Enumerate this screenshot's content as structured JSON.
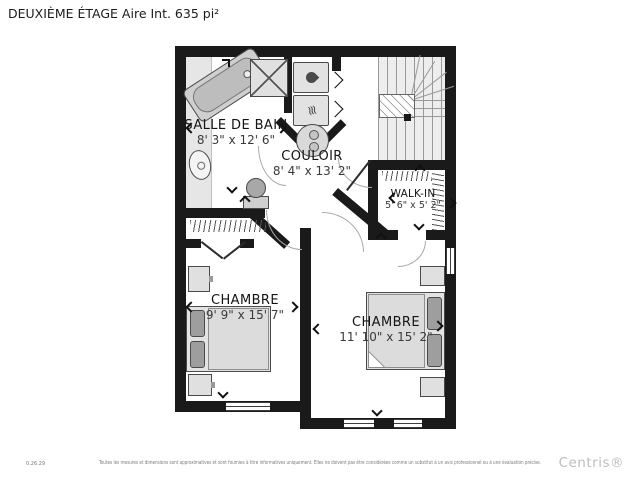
{
  "title": "DEUXIÈME ÉTAGE Aire Int. 635 pi²",
  "rooms": {
    "bathroom": {
      "name": "SALLE DE BAIN",
      "dims": "8' 3\" x 12' 6\""
    },
    "hallway": {
      "name": "COULOIR",
      "dims": "8' 4\" x 13' 2\""
    },
    "walkin": {
      "name": "WALK-IN",
      "dims": "5' 6\" x 5' 2\""
    },
    "bedroom_left": {
      "name": "CHAMBRE",
      "dims": "9' 9\" x 15' 7\""
    },
    "bedroom_right": {
      "name": "CHAMBRE",
      "dims": "11' 10\" x 15' 2\""
    }
  },
  "icons": {
    "dryer_heat": "≋",
    "washer_drop": "css-teardrop"
  },
  "footer": {
    "code": "0.26.29",
    "disclaimer": "Toutes les mesures et dimensions sont approximatives et sont fournies à titre informatives uniquement. Elles ne doivent pas être considérées comme un substitut à un avis professionnel ou à une évaluation précise.",
    "brand": "Centris®"
  },
  "colors": {
    "wall": "#1a1a1a",
    "fixture": "#dddddd",
    "dark_fixture": "#9e9e9e",
    "brand": "#bdbdbd"
  }
}
